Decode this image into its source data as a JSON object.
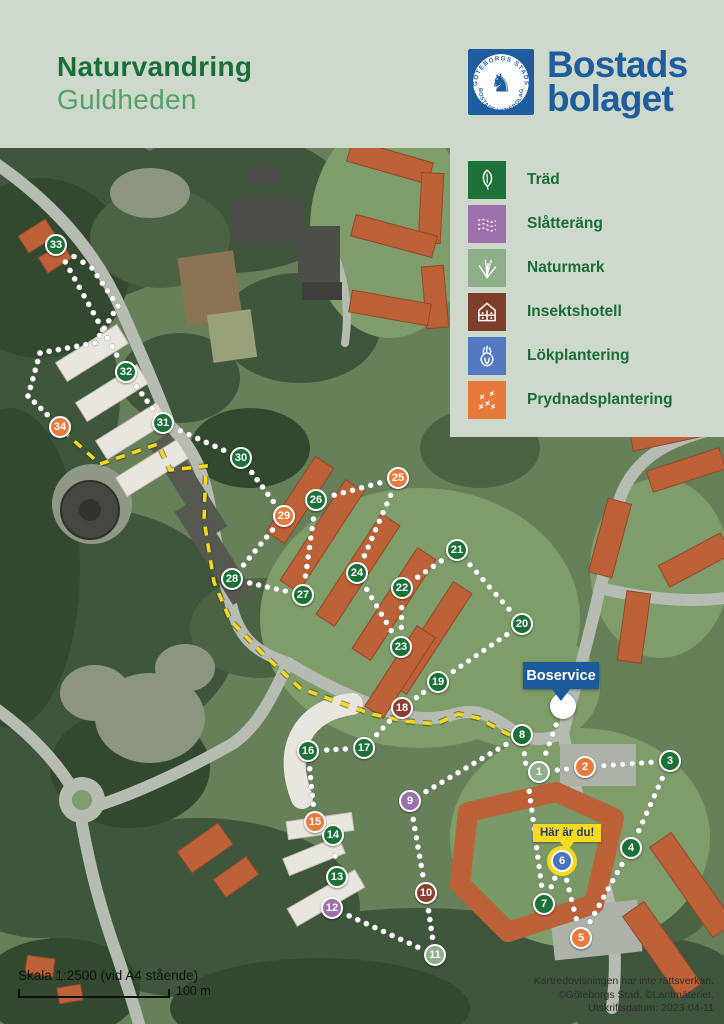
{
  "header": {
    "title_line1": "Naturvandring",
    "title_line2": "Guldheden",
    "brand": {
      "name_line1": "Bostads",
      "name_line2": "bolaget",
      "badge_text_top": "GÖTEBORGS STADS",
      "badge_text_bottom": "BOSTADSAKTIEBOLAG",
      "brand_color": "#1e5c9e"
    },
    "background_color": "#cdd9ca",
    "title_color_primary": "#1a6e39",
    "title_color_secondary": "#56a169"
  },
  "legend": {
    "items": [
      {
        "label": "Träd",
        "icon": "leaf-icon",
        "color": "#1d7038"
      },
      {
        "label": "Slåtteräng",
        "icon": "meadow-icon",
        "color": "#9c70ad"
      },
      {
        "label": "Naturmark",
        "icon": "grass-icon",
        "color": "#8fae8a"
      },
      {
        "label": "Insektshotell",
        "icon": "insect-hotel-icon",
        "color": "#7f3e2b"
      },
      {
        "label": "Lökplantering",
        "icon": "onion-icon",
        "color": "#5379c1"
      },
      {
        "label": "Prydnadsplantering",
        "icon": "flowers-icon",
        "color": "#e87a3c"
      }
    ],
    "label_color": "#1c6b3a",
    "panel_color": "#cdd9ca"
  },
  "map": {
    "start": {
      "x": 563,
      "y": 558,
      "label": "Boservice",
      "flag_color": "#1d5a9c"
    },
    "you_are_here": {
      "label": "Här är du!",
      "marker": 6,
      "flag_color": "#f8d921",
      "text_color": "#1d3d6e"
    },
    "category_colors": {
      "trad": "#1d7038",
      "slatterang": "#9c70ad",
      "naturmark": "#8fae8a",
      "insektshotell": "#8a4030",
      "lokplantering": "#4a72bd",
      "prydnadsplantering": "#e87a3c"
    },
    "markers": [
      {
        "n": 1,
        "x": 539,
        "y": 624,
        "cat": "naturmark"
      },
      {
        "n": 2,
        "x": 585,
        "y": 619,
        "cat": "prydnadsplantering"
      },
      {
        "n": 3,
        "x": 670,
        "y": 613,
        "cat": "trad"
      },
      {
        "n": 4,
        "x": 631,
        "y": 700,
        "cat": "trad"
      },
      {
        "n": 5,
        "x": 581,
        "y": 790,
        "cat": "prydnadsplantering"
      },
      {
        "n": 6,
        "x": 562,
        "y": 713,
        "cat": "lokplantering"
      },
      {
        "n": 7,
        "x": 544,
        "y": 756,
        "cat": "trad"
      },
      {
        "n": 8,
        "x": 522,
        "y": 587,
        "cat": "trad"
      },
      {
        "n": 9,
        "x": 410,
        "y": 653,
        "cat": "slatterang"
      },
      {
        "n": 10,
        "x": 426,
        "y": 745,
        "cat": "insektshotell"
      },
      {
        "n": 11,
        "x": 435,
        "y": 807,
        "cat": "naturmark"
      },
      {
        "n": 12,
        "x": 332,
        "y": 760,
        "cat": "slatterang"
      },
      {
        "n": 13,
        "x": 337,
        "y": 729,
        "cat": "trad"
      },
      {
        "n": 14,
        "x": 333,
        "y": 687,
        "cat": "trad"
      },
      {
        "n": 15,
        "x": 315,
        "y": 674,
        "cat": "prydnadsplantering"
      },
      {
        "n": 16,
        "x": 308,
        "y": 603,
        "cat": "trad"
      },
      {
        "n": 17,
        "x": 364,
        "y": 600,
        "cat": "trad"
      },
      {
        "n": 18,
        "x": 402,
        "y": 560,
        "cat": "insektshotell"
      },
      {
        "n": 19,
        "x": 438,
        "y": 534,
        "cat": "trad"
      },
      {
        "n": 20,
        "x": 522,
        "y": 476,
        "cat": "trad"
      },
      {
        "n": 21,
        "x": 457,
        "y": 402,
        "cat": "trad"
      },
      {
        "n": 22,
        "x": 402,
        "y": 440,
        "cat": "trad"
      },
      {
        "n": 23,
        "x": 401,
        "y": 499,
        "cat": "trad"
      },
      {
        "n": 24,
        "x": 357,
        "y": 425,
        "cat": "trad"
      },
      {
        "n": 25,
        "x": 398,
        "y": 330,
        "cat": "prydnadsplantering"
      },
      {
        "n": 26,
        "x": 316,
        "y": 352,
        "cat": "trad"
      },
      {
        "n": 27,
        "x": 303,
        "y": 447,
        "cat": "trad"
      },
      {
        "n": 28,
        "x": 232,
        "y": 431,
        "cat": "trad"
      },
      {
        "n": 29,
        "x": 284,
        "y": 368,
        "cat": "prydnadsplantering"
      },
      {
        "n": 30,
        "x": 241,
        "y": 310,
        "cat": "trad"
      },
      {
        "n": 31,
        "x": 163,
        "y": 275,
        "cat": "trad"
      },
      {
        "n": 32,
        "x": 126,
        "y": 224,
        "cat": "trad"
      },
      {
        "n": 33,
        "x": 56,
        "y": 97,
        "cat": "trad"
      },
      {
        "n": 34,
        "x": 60,
        "y": 279,
        "cat": "prydnadsplantering"
      }
    ],
    "route": [
      "start",
      1,
      2,
      3,
      4,
      5,
      6,
      7,
      8,
      9,
      10,
      11,
      12,
      13,
      14,
      15,
      16,
      17,
      18,
      19,
      20,
      21,
      22,
      23,
      24,
      25,
      26,
      27,
      28,
      29,
      30,
      31,
      32,
      33,
      [
        92,
        120
      ],
      [
        118,
        158
      ],
      [
        95,
        195
      ],
      [
        40,
        205
      ],
      [
        28,
        248
      ],
      34
    ],
    "alt_route_color": "#f2d821",
    "alt_route": [
      [
        62,
        282
      ],
      [
        100,
        316
      ],
      [
        158,
        296
      ],
      [
        170,
        322
      ],
      [
        206,
        318
      ],
      [
        204,
        372
      ],
      [
        214,
        434
      ],
      [
        230,
        472
      ],
      [
        262,
        505
      ],
      [
        300,
        540
      ],
      [
        338,
        554
      ],
      [
        372,
        566
      ],
      [
        404,
        573
      ],
      [
        436,
        576
      ],
      [
        458,
        566
      ],
      [
        478,
        570
      ],
      [
        504,
        584
      ],
      [
        520,
        592
      ]
    ]
  },
  "scale": {
    "text": "Skala 1:2500 (vid A4 stående)",
    "bar_label": "100 m"
  },
  "attribution": {
    "lines": [
      "Kartredovisningen har inte rättsverkan.",
      "©Göteborgs Stad. ©Lantmäteriet.",
      "Utskriftsdatum: 2023-04-11"
    ]
  }
}
